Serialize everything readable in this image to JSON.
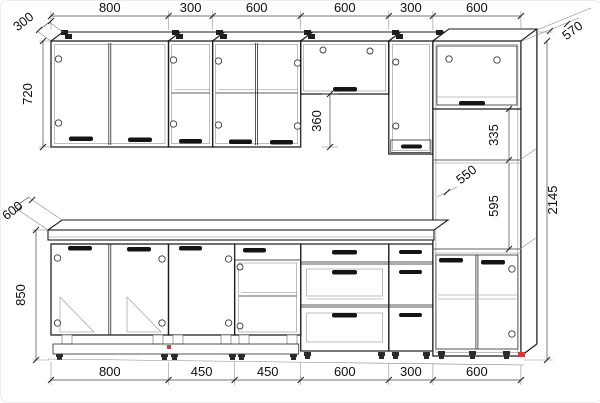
{
  "dims": {
    "top": [
      "800",
      "300",
      "600",
      "600",
      "300",
      "600"
    ],
    "bottom": [
      "800",
      "450",
      "450",
      "600",
      "300",
      "600"
    ],
    "left": {
      "wall_depth": "300",
      "wall_height": "720",
      "counter_depth": "600",
      "base_height": "850"
    },
    "right": {
      "tall_depth": "570",
      "total_height": "2145"
    },
    "inner": {
      "flip_gap": "360",
      "tall_open_upper": "335",
      "shelf_depth": "550",
      "tall_open_lower": "595"
    }
  },
  "colors": {
    "line": "#1b1b1b",
    "accent_red": "#d03c36",
    "background": "#ffffff"
  }
}
